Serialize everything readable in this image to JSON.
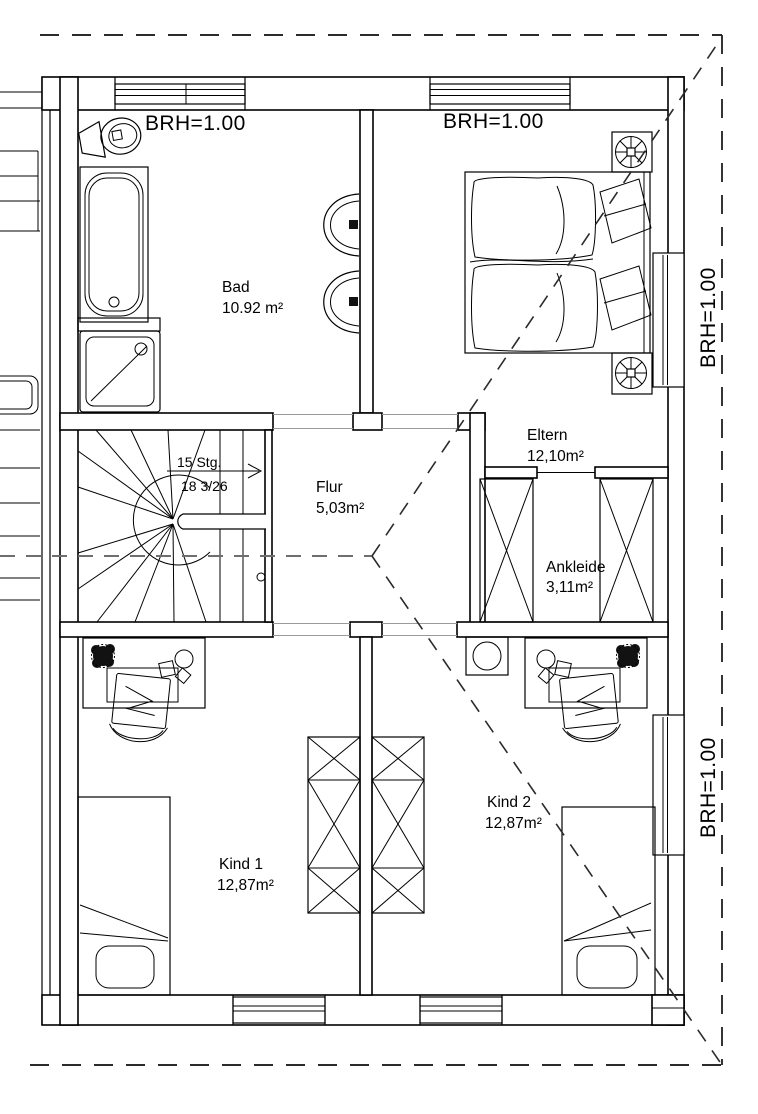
{
  "colors": {
    "line": "#000000",
    "background": "#ffffff",
    "dashed_roof": "#2b2b2b",
    "opening": "#9a9a9a"
  },
  "window_labels": {
    "brh_top_left": "BRH=1.00",
    "brh_top_right": "BRH=1.00",
    "brh_right_upper": "BRH=1.00",
    "brh_right_lower": "BRH=1.00"
  },
  "rooms": [
    {
      "name": "Bad",
      "area": "10.92 m²"
    },
    {
      "name": "Eltern",
      "area": "12,10m²"
    },
    {
      "name": "Ankleide",
      "area": "3,11m²"
    },
    {
      "name": "Flur",
      "area": "5,03m²"
    },
    {
      "name": "Kind 1",
      "area": "12,87m²"
    },
    {
      "name": "Kind 2",
      "area": "12,87m²"
    }
  ],
  "stairs": {
    "steps_label": "15 Stg.",
    "dimensions_label": "18 3/26"
  }
}
